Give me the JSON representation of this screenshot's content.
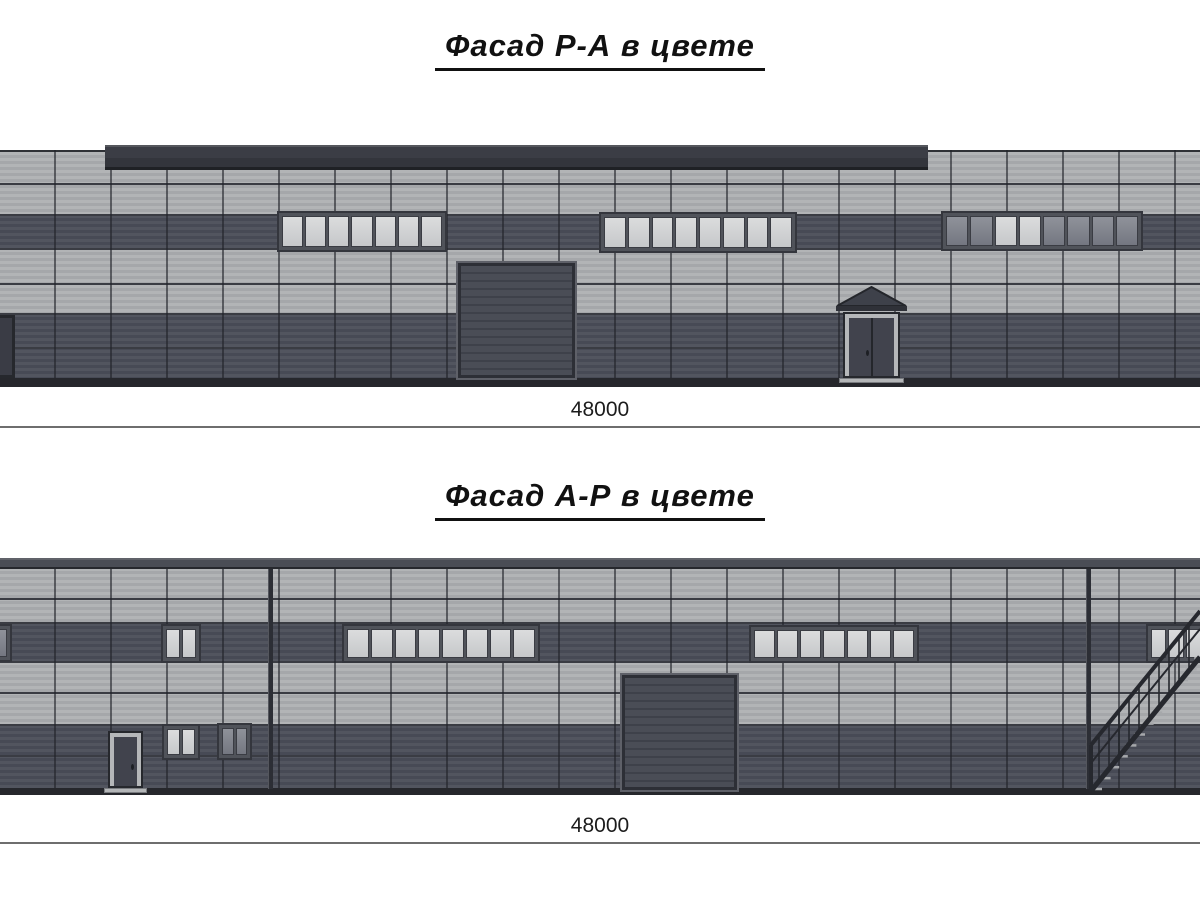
{
  "sheet": {
    "background": "#ffffff"
  },
  "colors": {
    "panel_light": "#aeb0b3",
    "panel_dark": "#4c4f5b",
    "fascia": "#3b3d45",
    "window_frame": "#50535a",
    "glass_light": "#d2d4d5",
    "glass_tinted": "#868993",
    "door_dark": "#45474f",
    "ground": "#26272c",
    "dimension_line": "#6e6e6e",
    "text": "#111111"
  },
  "facades": [
    {
      "title": "Фасад Р-А в цвете",
      "dimension": "48000",
      "title_top": 28,
      "dim_label_top": 398,
      "dim_line_y": 426,
      "geometry": {
        "wall": {
          "x": 0,
          "y": 150,
          "w": 1200,
          "h": 228
        },
        "fascia": {
          "x": 105,
          "y": 145,
          "w": 823,
          "h": 25
        },
        "bands": [
          {
            "shade": "light",
            "y": 152,
            "h": 63
          },
          {
            "shade": "dark",
            "y": 215,
            "h": 34
          },
          {
            "shade": "light",
            "y": 249,
            "h": 65
          },
          {
            "shade": "dark",
            "y": 314,
            "h": 64
          }
        ],
        "joints_y": [
          183,
          283,
          347
        ],
        "top_line_y": 150,
        "base": {
          "x": 0,
          "y": 378,
          "w": 1200,
          "h": 9
        },
        "windows": [
          {
            "x": 277,
            "y": 211,
            "w": 170,
            "h": 41,
            "panes": 7,
            "glass": "light"
          },
          {
            "x": 599,
            "y": 212,
            "w": 198,
            "h": 41,
            "panes": 8,
            "glass": "light"
          },
          {
            "x": 941,
            "y": 211,
            "w": 202,
            "h": 40,
            "panes": 8,
            "glass": "tinted",
            "light_panes": [
              2,
              3
            ]
          }
        ],
        "overhead_doors": [
          {
            "x": 458,
            "y": 263,
            "w": 117,
            "h": 115
          }
        ],
        "entry_doors": [
          {
            "x": 843,
            "y": 312,
            "w": 57,
            "h": 66,
            "double": true,
            "canopy": true
          }
        ],
        "edge_doors": [
          {
            "x": 0,
            "y": 315,
            "w": 15,
            "h": 63
          }
        ],
        "downpipes": [],
        "stairs": null
      }
    },
    {
      "title": "Фасад А-Р в цвете",
      "dimension": "48000",
      "title_top": 478,
      "dim_label_top": 814,
      "dim_line_y": 842,
      "geometry": {
        "wall": {
          "x": 0,
          "y": 568,
          "w": 1200,
          "h": 220
        },
        "coping": {
          "x": 0,
          "y": 558,
          "w": 1200,
          "h": 11
        },
        "bands": [
          {
            "shade": "light",
            "y": 568,
            "h": 55
          },
          {
            "shade": "dark",
            "y": 623,
            "h": 39
          },
          {
            "shade": "light",
            "y": 662,
            "h": 63
          },
          {
            "shade": "dark",
            "y": 725,
            "h": 63
          }
        ],
        "joints_y": [
          598,
          692,
          755
        ],
        "base": {
          "x": 0,
          "y": 788,
          "w": 1200,
          "h": 7
        },
        "windows": [
          {
            "x": -8,
            "y": 624,
            "w": 20,
            "h": 38,
            "panes": 1,
            "glass": "tinted"
          },
          {
            "x": 161,
            "y": 624,
            "w": 40,
            "h": 39,
            "panes": 2,
            "glass": "light"
          },
          {
            "x": 342,
            "y": 624,
            "w": 198,
            "h": 39,
            "panes": 8,
            "glass": "light"
          },
          {
            "x": 749,
            "y": 625,
            "w": 170,
            "h": 38,
            "panes": 7,
            "glass": "light"
          },
          {
            "x": 1146,
            "y": 624,
            "w": 60,
            "h": 39,
            "panes": 3,
            "glass": "light"
          },
          {
            "x": 162,
            "y": 724,
            "w": 38,
            "h": 36,
            "panes": 2,
            "glass": "light"
          },
          {
            "x": 217,
            "y": 723,
            "w": 35,
            "h": 37,
            "panes": 2,
            "glass": "tinted"
          }
        ],
        "overhead_doors": [
          {
            "x": 622,
            "y": 675,
            "w": 115,
            "h": 115
          }
        ],
        "entry_doors": [
          {
            "x": 108,
            "y": 731,
            "w": 35,
            "h": 57,
            "double": false,
            "canopy": false
          }
        ],
        "edge_doors": [],
        "downpipes": [
          {
            "x": 268,
            "y": 569,
            "h": 220
          },
          {
            "x": 1086,
            "y": 569,
            "h": 220
          }
        ],
        "stairs": {
          "x": 1085,
          "y": 597,
          "w": 115,
          "h": 196
        }
      }
    }
  ]
}
